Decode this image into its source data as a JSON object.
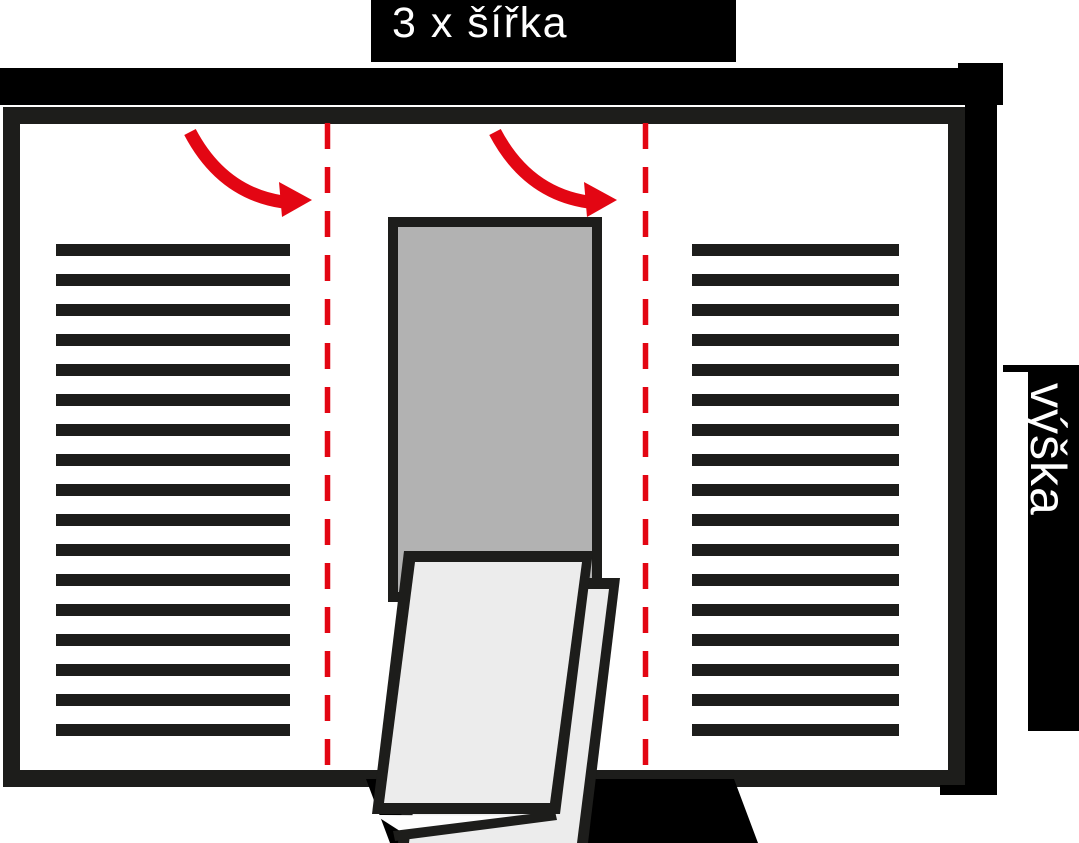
{
  "labels": {
    "width_dimension": "3 x šířka",
    "height_dimension": "výška"
  },
  "colors": {
    "accent_red": "#e30613",
    "ink": "#1d1d1b",
    "bar_black": "#000000",
    "panel_gray": "#b2b2b2",
    "page_light": "#ececec",
    "page_white": "#fdfdfd",
    "background": "#ffffff"
  },
  "layout_data": {
    "text_lines": {
      "count_per_panel": 17,
      "start_y": 244,
      "pitch": 30,
      "line_height": 12,
      "left_panel": {
        "x": 56,
        "width": 234
      },
      "right_panel": {
        "x": 692,
        "width": 207
      }
    },
    "fold_lines": {
      "x_positions": [
        327.5,
        645.5
      ],
      "y_top": 123,
      "y_bottom": 781,
      "dash_length": 26,
      "gap_length": 18,
      "stroke_width": 5.5
    }
  }
}
